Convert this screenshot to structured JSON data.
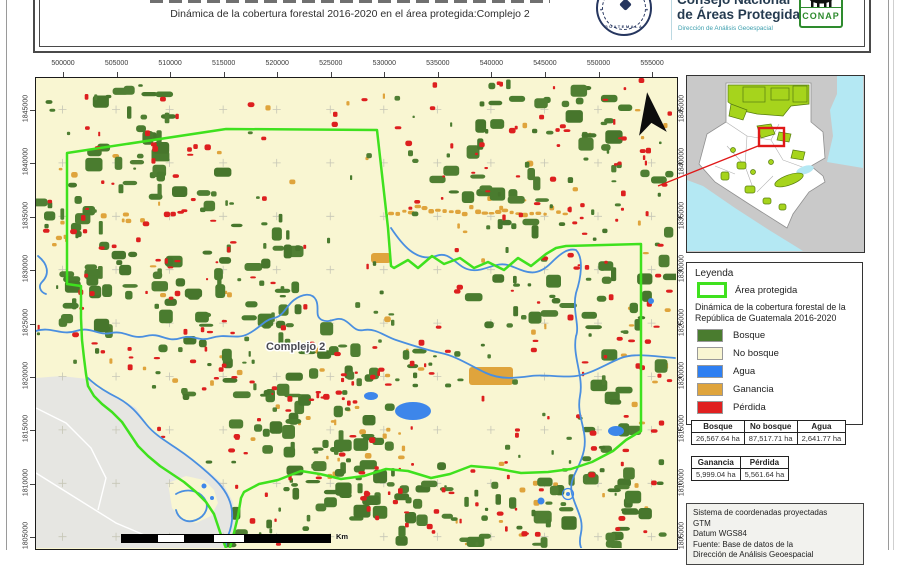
{
  "header": {
    "subtitle": "Dinámica de la cobertura forestal 2016-2020 en el área protegida:Complejo 2",
    "org_name_line1": "Consejo Nacional",
    "org_name_line2": "de Áreas Protegidas",
    "org_dept": "Dirección de Análisis Geoespacial",
    "conap_label": "CONAP",
    "seal_text": "GUATEMALA"
  },
  "map": {
    "label": "Complejo 2",
    "scale_unit": "Km",
    "x_ticks": [
      "500000",
      "505000",
      "510000",
      "515000",
      "520000",
      "525000",
      "530000",
      "535000",
      "540000",
      "545000",
      "550000",
      "555000"
    ],
    "y_ticks": [
      "1845000",
      "1840000",
      "1835000",
      "1830000",
      "1825000",
      "1820000",
      "1815000",
      "1810000",
      "1805000"
    ]
  },
  "legend": {
    "title": "Leyenda",
    "area_label": "Área protegida",
    "subtitle": "Dinámica de la cobertura forestal de la República de Guatemala 2016-2020",
    "items": [
      {
        "label": "Bosque",
        "color": "#4a7c2f"
      },
      {
        "label": "No bosque",
        "color": "#f9f6d2"
      },
      {
        "label": "Agua",
        "color": "#2e7ff2"
      },
      {
        "label": "Ganancia",
        "color": "#dfa43c"
      },
      {
        "label": "Pérdida",
        "color": "#e02020"
      }
    ]
  },
  "tables": {
    "table1": {
      "headers": [
        "Bosque",
        "No bosque",
        "Agua"
      ],
      "values": [
        "26,567.64 ha",
        "87,517.71 ha",
        "2,641.77 ha"
      ]
    },
    "table2": {
      "headers": [
        "Ganancia",
        "Pérdida"
      ],
      "values": [
        "5,999.04 ha",
        "5,561.64 ha"
      ]
    }
  },
  "info_box": {
    "lines": [
      "Sistema de coordenadas proyectadas",
      "GTM",
      "Datum WGS84",
      "Fuente: Base de datos de la",
      "Dirección de Análisis Geoespacial"
    ]
  },
  "colors": {
    "bosque": "#4a7c2f",
    "no_bosque": "#f9f6d2",
    "agua": "#3d86ea",
    "river": "#4a8fe0",
    "ganancia": "#dfa43c",
    "perdida": "#dd1f1f",
    "boundary": "#3fe11e",
    "inset_pa": "#a6d41c",
    "inset_water": "#b4e8f3",
    "extent_red": "#e01818"
  }
}
